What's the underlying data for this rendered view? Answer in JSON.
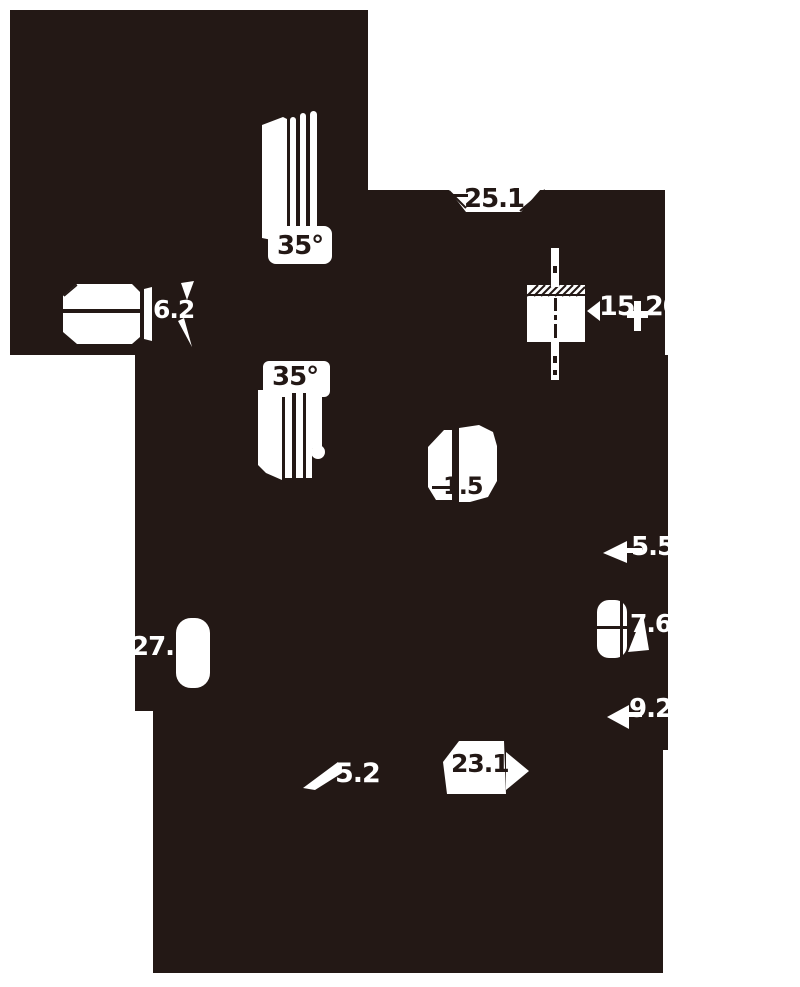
{
  "drawing": {
    "description": "technical-dimension-drawing",
    "ink_color": "#231815",
    "paper_color": "#ffffff",
    "labels": {
      "dim_25_1": "25.1",
      "angle_35_top": "35°",
      "dim_6_2": "6.2",
      "dim_15": "15",
      "angle_20": "20°",
      "angle_35_mid": "35°",
      "dim_1_5": "1.5",
      "dim_27_5": "27.5",
      "dim_5_5": "5.5",
      "dim_7_6": "7.6",
      "dim_9_2": "9.2",
      "dim_5_2": "5.2",
      "dim_23_1": "23.1"
    }
  }
}
